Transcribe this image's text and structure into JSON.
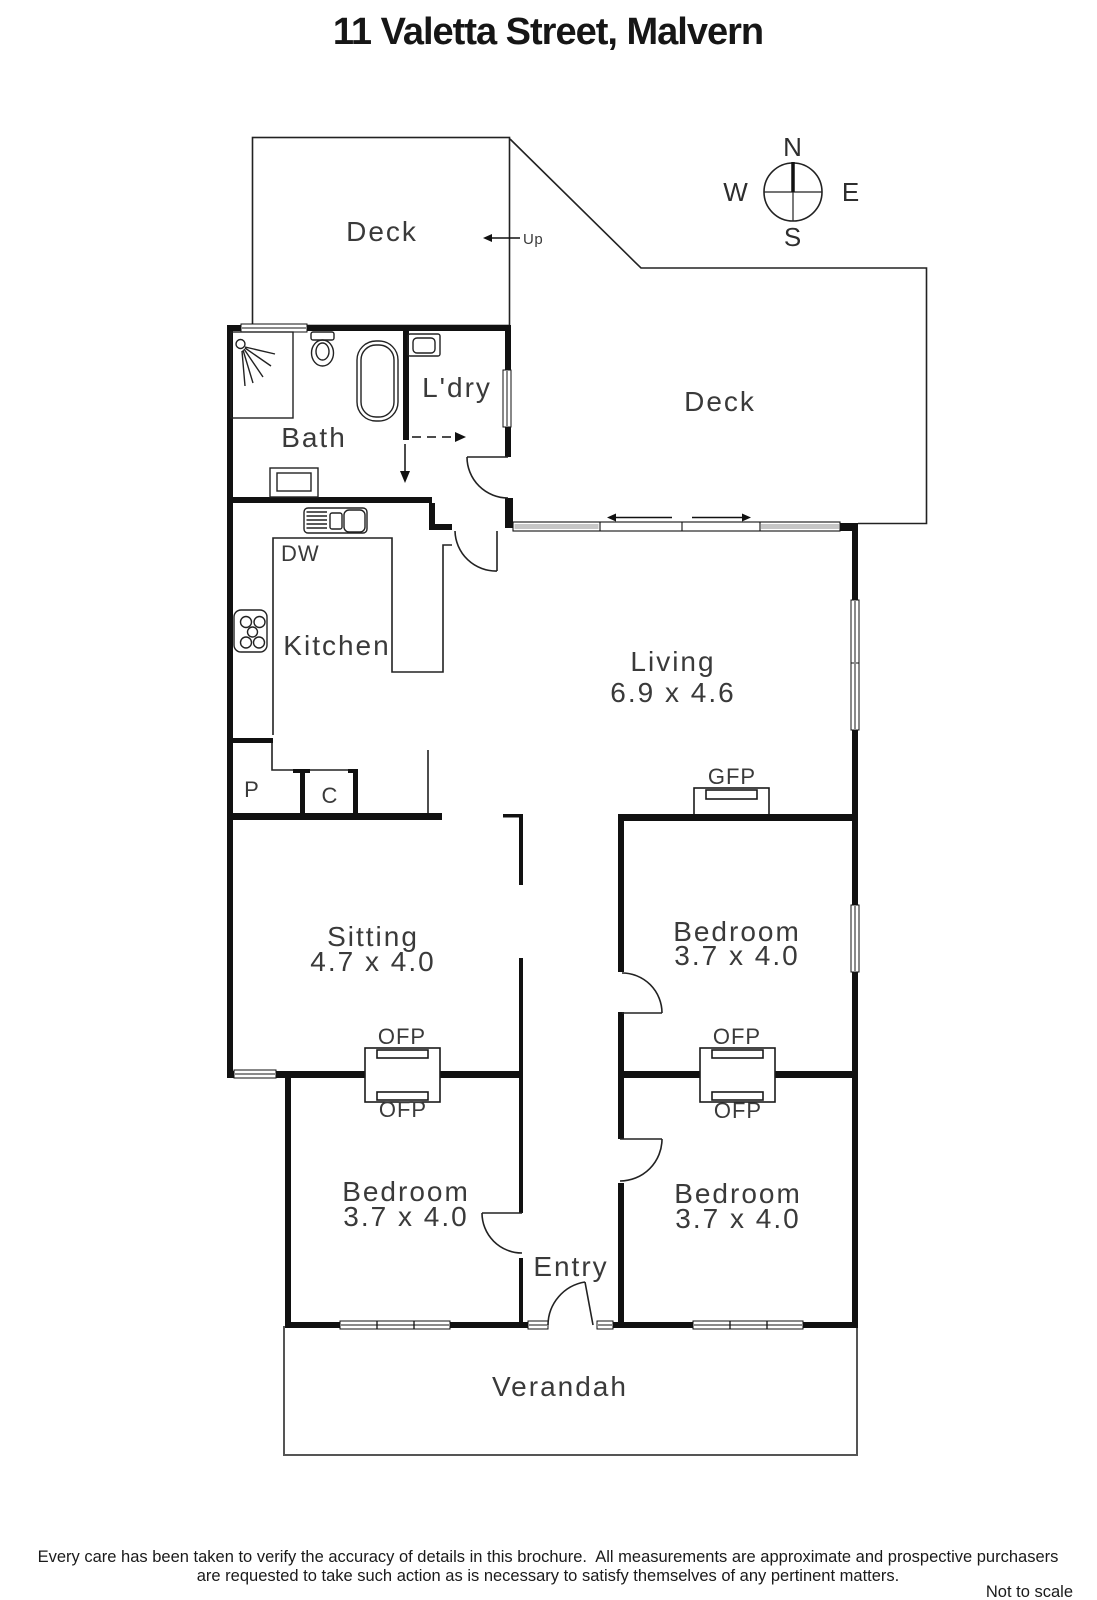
{
  "title": "11 Valetta Street, Malvern",
  "compass": {
    "north": "N",
    "south": "S",
    "east": "E",
    "west": "W"
  },
  "labels": {
    "deck_upper": "Deck",
    "up": "Up",
    "deck_east": "Deck",
    "bath": "Bath",
    "laundry": "L'dry",
    "dishwasher": "DW",
    "kitchen": "Kitchen",
    "pantry": "P",
    "cupboard": "C",
    "gas_fireplace": "GFP",
    "open_fireplace_sitting": "OFP",
    "open_fireplace_bed1": "OFP",
    "open_fireplace_bed2": "OFP",
    "open_fireplace_bed3": "OFP",
    "entry": "Entry",
    "verandah": "Verandah"
  },
  "rooms": {
    "living": {
      "name": "Living",
      "dims": "6.9 x 4.6"
    },
    "sitting": {
      "name": "Sitting",
      "dims": "4.7 x 4.0"
    },
    "bedroom1": {
      "name": "Bedroom",
      "dims": "3.7 x 4.0"
    },
    "bedroom2": {
      "name": "Bedroom",
      "dims": "3.7 x 4.0"
    },
    "bedroom3": {
      "name": "Bedroom",
      "dims": "3.7 x 4.0"
    }
  },
  "footer": {
    "line1": "Every care has been taken to verify the accuracy of details in this brochure.  All measurements are approximate and prospective purchasers",
    "line2": "are requested to take such action as is necessary to satisfy themselves of any pertinent matters.",
    "scale_note": "Not to scale"
  },
  "colors": {
    "wall": "#111111",
    "line": "#222222",
    "text": "#3a3a3a",
    "window_mid": "#8a8a8a",
    "panel_gray": "#c6c6c6"
  }
}
